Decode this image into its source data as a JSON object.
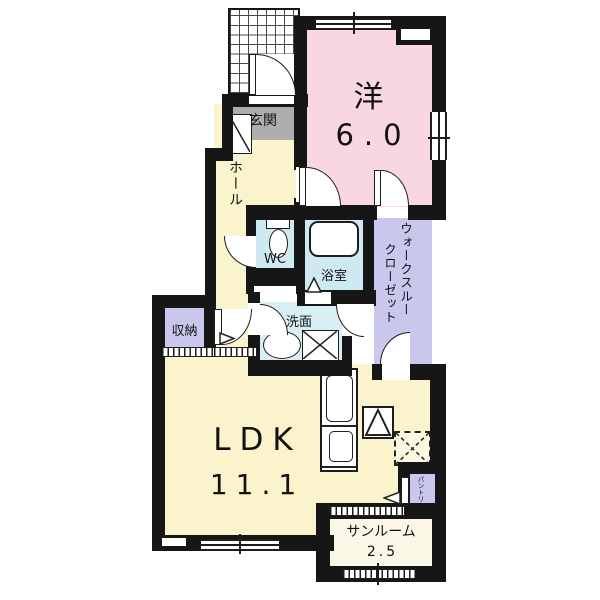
{
  "plan_type": "apartment-floorplan",
  "colors": {
    "wall": "#161616",
    "room_yellow": "#faf3cc",
    "room_pink": "#f8d7e2",
    "room_blue": "#cfe9f2",
    "room_blue_light": "#d8eef5",
    "room_purple": "#c9c7ec",
    "entrance_gray": "#aeaeae",
    "sunroom_cream": "#fbf7e6",
    "background": "#ffffff"
  },
  "rooms": {
    "western": {
      "name": "洋",
      "area": "6.0"
    },
    "entrance": {
      "name": "玄関"
    },
    "hall": {
      "name": "ホール"
    },
    "wc": {
      "name": "WC"
    },
    "bath": {
      "name": "浴室"
    },
    "washroom": {
      "name": "洗面"
    },
    "storage": {
      "name": "収納"
    },
    "walk_through_closet": {
      "line1": "ウォークスルー",
      "line2": "クローゼット"
    },
    "ldk": {
      "name": "LDK",
      "area": "11.1"
    },
    "sunroom": {
      "name": "サンルーム",
      "area": "2.5"
    },
    "pantry": {
      "name": "パントリー"
    }
  },
  "fixtures": [
    "toilet",
    "bathtub",
    "washbasin",
    "washing-machine",
    "kitchen-counter",
    "refrigerator",
    "laundry-space"
  ]
}
